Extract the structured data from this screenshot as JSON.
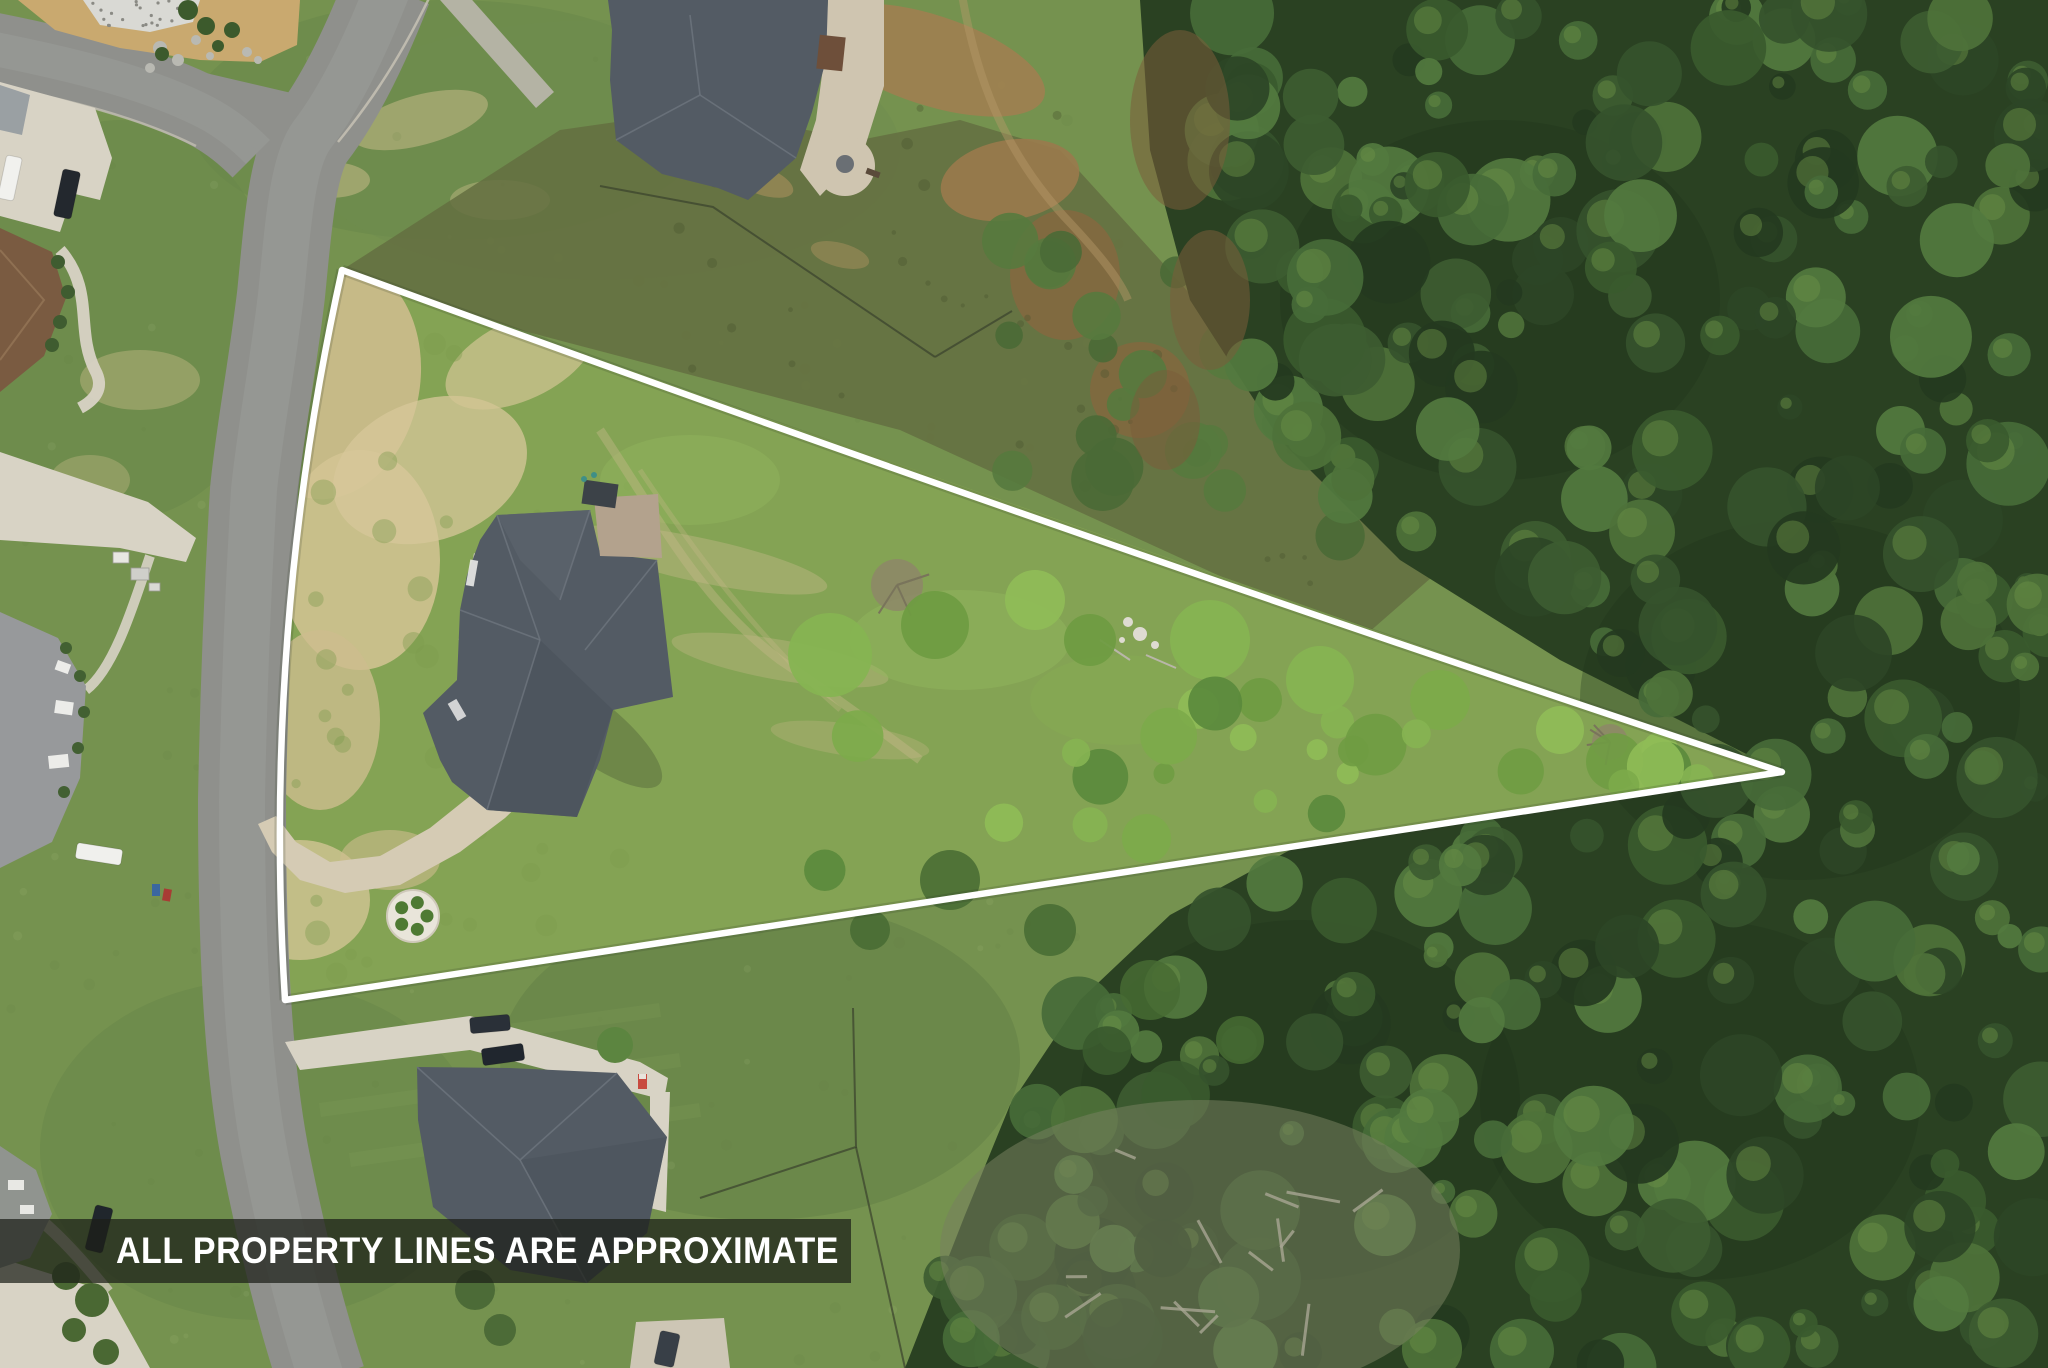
{
  "overlay": {
    "disclaimer_text": "ALL PROPERTY LINES ARE APPROXIMATE",
    "banner_background": "rgba(28,31,24,0.72)",
    "banner_text_color": "#ffffff",
    "property_line_color": "#ffffff"
  },
  "scene": {
    "kind": "aerial-drone-photo",
    "features": [
      "triangular-outlined-lot",
      "curved-residential-street",
      "lot-house-dark-gray-roof",
      "curved-concrete-driveway",
      "circular-planting-bed",
      "neighboring-houses",
      "dense-forest-east",
      "scrub-and-dirt-patches",
      "rock-landscape-bed",
      "parked-vehicles",
      "fence-lines",
      "fallen-logs-clearing"
    ],
    "palette": {
      "grass": "#75924f",
      "grassDark": "#67854a",
      "grassLight": "#8fae5c",
      "lotGrass": "#84a354",
      "dry": "#cdbd8d",
      "dryDeep": "#d7c79a",
      "scrub": "#646f41",
      "dirt": "#a08050",
      "dirtDark": "#85683f",
      "forest": "#2a4122",
      "forestMid": "#3a5a2e",
      "forestLight": "#4e7239",
      "treeBright": "#7cab4a",
      "road": "#8f908c",
      "roadLight": "#9c9d99",
      "concrete": "#d8d3c5",
      "concreteWarm": "#d5cbb4",
      "roofDark": "#535b64",
      "roofFacet": "#49515a",
      "roofLight": "#6e767e",
      "roofBrown": "#7a5b41",
      "line": "#ffffff"
    }
  }
}
